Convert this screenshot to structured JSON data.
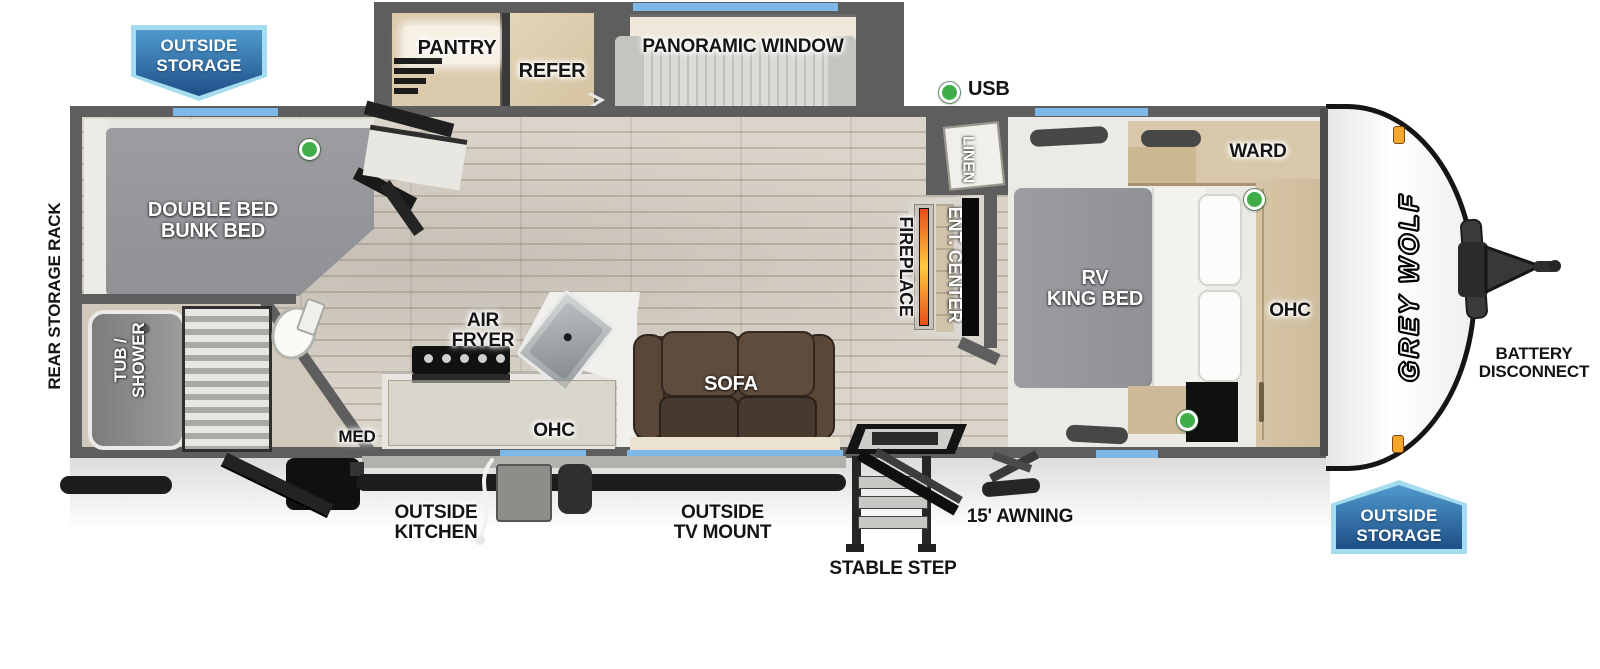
{
  "brand": "GREY WOLF",
  "banners": {
    "top_left": {
      "line1": "OUTSIDE",
      "line2": "STORAGE"
    },
    "bottom_right": {
      "line1": "OUTSIDE",
      "line2": "STORAGE"
    }
  },
  "exterior": {
    "rear_storage_rack": "REAR STORAGE RACK",
    "usb": "USB",
    "battery": {
      "line1": "BATTERY",
      "line2": "DISCONNECT"
    },
    "outside_kitchen": {
      "line1": "OUTSIDE",
      "line2": "KITCHEN"
    },
    "outside_tv_mount": {
      "line1": "OUTSIDE",
      "line2": "TV MOUNT"
    },
    "stable_step": "STABLE STEP",
    "awning": "15' AWNING"
  },
  "interior": {
    "pantry": "PANTRY",
    "refer": "REFER",
    "panoramic_window": "PANORAMIC WINDOW",
    "dinette": "DINETTE",
    "bunk": {
      "line1": "DOUBLE BED",
      "line2": "BUNK BED"
    },
    "tub": {
      "line1": "TUB /",
      "line2": "SHOWER"
    },
    "med": "MED",
    "air_fryer": {
      "line1": "AIR",
      "line2": "FRYER"
    },
    "ohc_kitchen": "OHC",
    "sofa": "SOFA",
    "fireplace": "FIREPLACE",
    "ent_center": "ENT. CENTER",
    "linen": "LINEN",
    "king_bed": {
      "line1": "RV",
      "line2": "KING BED"
    },
    "ward": "WARD",
    "ohc_bedroom": "OHC"
  },
  "colors": {
    "banner_blue_light": "#4f9ace",
    "banner_blue_dark": "#1e4f86",
    "banner_border": "#a5dcee",
    "window_blue": "#7db8e8",
    "indicator_green": "#3fae49",
    "wall_gray": "#5e5e5e",
    "cabinet_tan": "#d8c7a8",
    "sofa_brown": "#4f3f33",
    "fireplace_orange": "#f26a2a",
    "marker_light_orange": "#f6a62a"
  }
}
